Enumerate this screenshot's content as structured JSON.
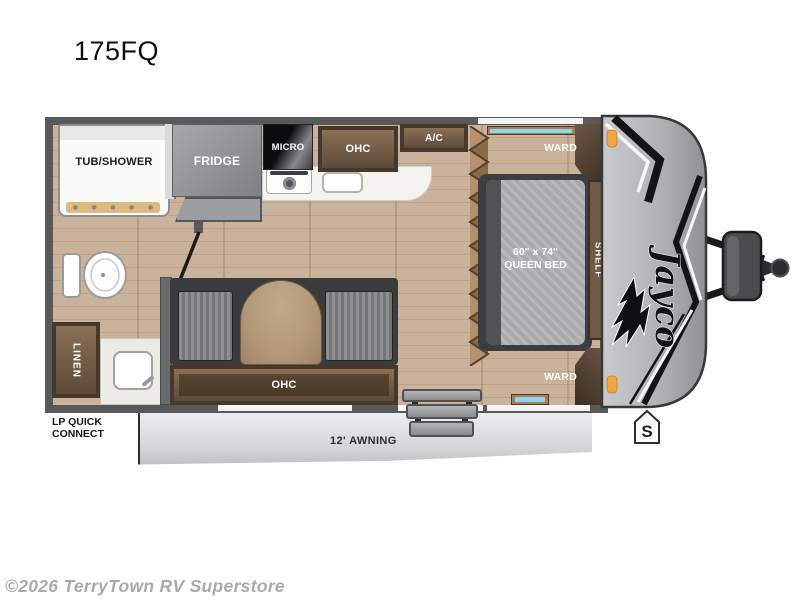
{
  "title": "175FQ",
  "watermark": "©2026 TerryTown RV Superstore",
  "brand": {
    "logo_text": "Jayco"
  },
  "floorplan": {
    "labels": {
      "tub_shower": "TUB/SHOWER",
      "fridge": "FRIDGE",
      "micro": "MICRO",
      "ohc_kitchen": "OHC",
      "ac": "A/C",
      "ward_top": "WARD",
      "ward_bottom": "WARD",
      "shelf": "SHELF",
      "linen": "LINEN",
      "bed_size": "60\" x 74\"",
      "bed_type": "QUEEN BED",
      "ohc_dinette": "OHC",
      "awning": "12' AWNING",
      "lp_quick_connect_line1": "LP QUICK",
      "lp_quick_connect_line2": "CONNECT",
      "spare_tire_marker": "S"
    }
  },
  "colors": {
    "wall": "#58595b",
    "floor_light": "#cbb29a",
    "floor_dark": "#bca388",
    "cabinet_edge": "#46382b",
    "cabinet_face": "#7b6349",
    "counter": "#f4f3f0",
    "appliance_gray": "#8f9193",
    "mattress": "#b0b1b3",
    "cushion": "#85878a",
    "table_wood": "#b29877",
    "awning_gray": "#d3d4d6",
    "cap_gray": "#b0b2b4",
    "window_teal": "#8ed7e6",
    "marker_orange": "#f4a63e",
    "text_dark": "#1b1b1d",
    "text_light": "#ffffff"
  }
}
